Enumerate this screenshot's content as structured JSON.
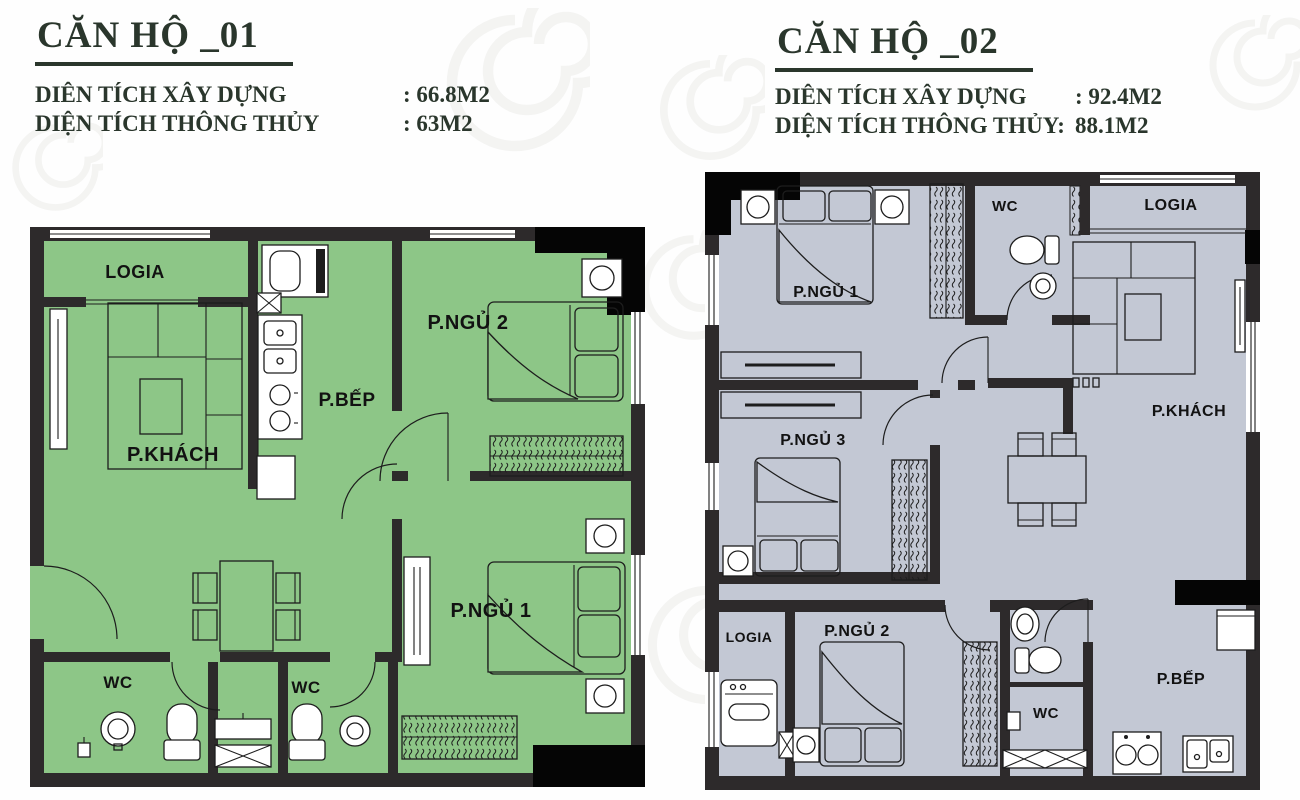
{
  "colors": {
    "wall": "#2d2a2b",
    "black_block": "#050505",
    "plan1_fill": "#8dc687",
    "plan2_fill": "#c3c8d4",
    "title_text": "#2a362c",
    "label_text": "#121212",
    "ornament": "#ececea"
  },
  "plan1": {
    "title": "CĂN HỘ _01",
    "areas": [
      {
        "label": "DIÊN TÍCH XÂY DỰNG",
        "value": ": 66.8M2"
      },
      {
        "label": "DIỆN TÍCH THÔNG THỦY",
        "value": ": 63M2"
      }
    ],
    "rooms": {
      "logia": "LOGIA",
      "khach": "P.KHÁCH",
      "bep": "P.BẾP",
      "ngu2": "P.NGỦ 2",
      "ngu1": "P.NGỦ 1",
      "wc1": "WC",
      "wc2": "WC"
    }
  },
  "plan2": {
    "title": "CĂN HỘ _02",
    "areas": [
      {
        "label": "DIÊN TÍCH XÂY DỰNG",
        "value": ": 92.4M2"
      },
      {
        "label": "DIỆN TÍCH THÔNG THỦY:",
        "value": "88.1M2"
      }
    ],
    "rooms": {
      "ngu1": "P.NGỦ 1",
      "wc_top": "WC",
      "logia_top": "LOGIA",
      "khach": "P.KHÁCH",
      "ngu3": "P.NGỦ 3",
      "ngu2": "P.NGỦ 2",
      "logia_bottom": "LOGIA",
      "wc_bottom": "WC",
      "bep": "P.BẾP"
    }
  }
}
